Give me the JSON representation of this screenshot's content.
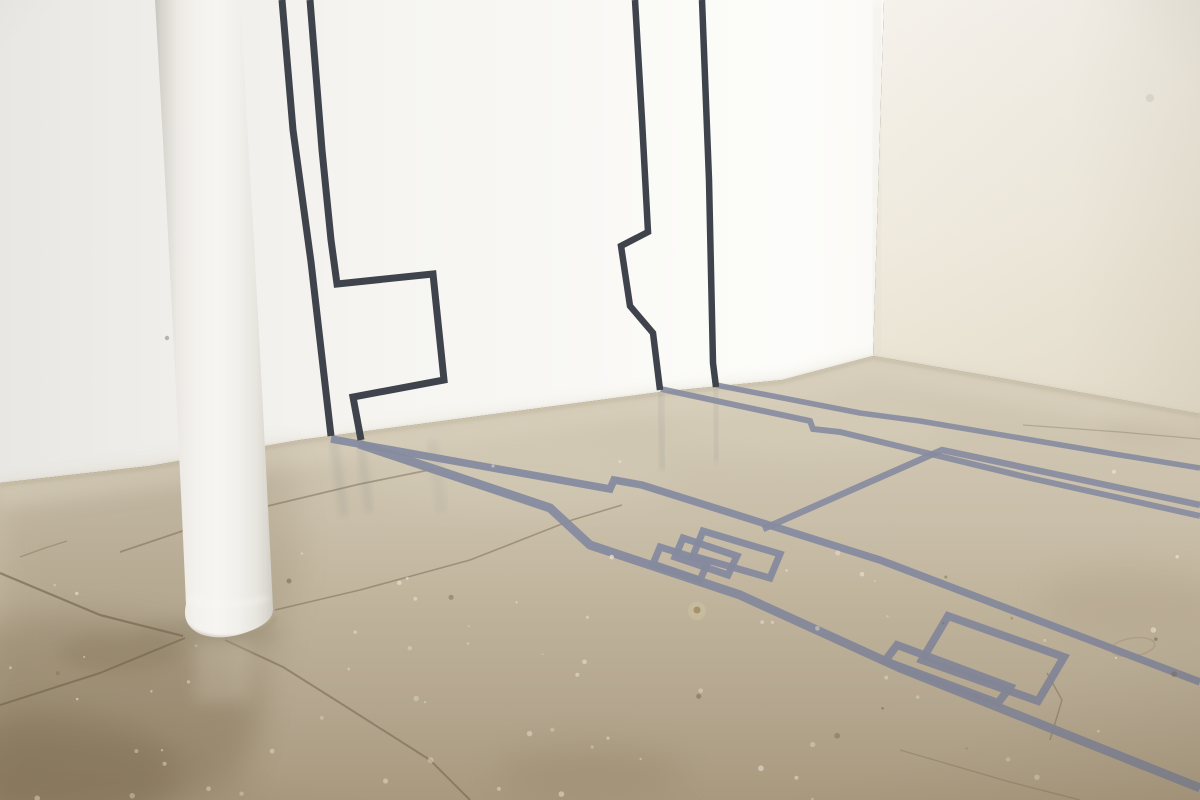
{
  "scene": {
    "label": "gallery-installation-photograph",
    "description": "White gallery room corner with a white cylindrical column at left; dark charcoal tape lines form an angular wall drawing that continues as a blue-grey tape drawing across a polished tan concrete floor with cracks and stains."
  },
  "colors": {
    "wall_tape": "#3f434c",
    "floor_tape": "#868ba0",
    "crack": "#6f5f49",
    "back_wall_bright": "#fcfcfa",
    "back_wall_dim": "#e9e7e3",
    "right_wall": "#f0ebdf",
    "floor_light": "#d4ccba",
    "floor_mid": "#c5b9a2",
    "floor_dark": "#b7a88e",
    "column_bright": "#f7f5f1",
    "column_shadow": "#c8c5be"
  },
  "artwork": {
    "wall_tape_paths": [
      {
        "name": "wall-tape-left-outer-line",
        "points": "282,0 293,130 311,262 331,436",
        "width": 7
      },
      {
        "name": "wall-tape-left-flag-line",
        "points": "310,0 322,150 331,240 337,284 433,274 444,380 353,397 361,440",
        "width": 7
      },
      {
        "name": "wall-tape-right-step-line",
        "points": "635,0 642,120 648,232 621,246 630,306 653,333 660,390",
        "width": 6.5
      },
      {
        "name": "wall-tape-right-straight-line",
        "points": "702,0 709,180 713,363 716,387",
        "width": 6.5
      }
    ],
    "floor_tape_paths": [
      {
        "name": "floor-tape-left-upper-diagonal",
        "points": "331,439 610,489 614,480 642,485 880,560 1200,682",
        "width": 7.5,
        "opacity": 0.95
      },
      {
        "name": "floor-tape-left-lower-diagonal",
        "points": "359,444 550,508 590,545 740,595 900,668 1200,788",
        "width": 9,
        "opacity": 0.95
      },
      {
        "name": "floor-tape-right-wall-parallel",
        "points": "716,385 860,413 920,421 1120,455 1200,468",
        "width": 5.5,
        "opacity": 0.9
      },
      {
        "name": "floor-tape-right-step-diagonal",
        "points": "661,389 810,421 813,429 840,432 1030,478 1200,516",
        "width": 6,
        "opacity": 0.9
      },
      {
        "name": "floor-tape-center-chevron",
        "points": "763,529 942,450 1200,505",
        "width": 6.5,
        "opacity": 0.9
      }
    ],
    "floor_comb_polygons": [
      {
        "name": "center-comb-bar-1",
        "points": "660,547 708,562 700,580 653,564",
        "width": 7
      },
      {
        "name": "center-comb-bar-2",
        "points": "683,538 737,556 728,575 675,557",
        "width": 7
      },
      {
        "name": "center-comb-bar-3",
        "points": "703,531 780,554 770,578 693,556",
        "width": 7
      },
      {
        "name": "front-comb-bar-large",
        "points": "948,616 1064,657 1038,701 922,660",
        "width": 8
      },
      {
        "name": "front-comb-bar-small",
        "points": "897,645 1010,687 998,703 885,661",
        "width": 8
      }
    ]
  },
  "floor": {
    "cracks": [
      {
        "name": "joint-left-to-column",
        "points": "0,573 100,615 183,636",
        "width": 2.2,
        "opacity": 0.6
      },
      {
        "name": "joint-behind-column",
        "points": "120,552 230,515 360,484 434,469",
        "width": 1.8,
        "opacity": 0.45
      },
      {
        "name": "joint-right-of-column",
        "points": "275,610 360,590 470,560 572,520 622,505",
        "width": 1.6,
        "opacity": 0.45
      },
      {
        "name": "joint-base-down-left",
        "points": "185,638 100,673 0,705",
        "width": 2,
        "opacity": 0.55
      },
      {
        "name": "joint-base-down-right",
        "points": "225,640 283,667 345,706 430,760 470,800",
        "width": 2,
        "opacity": 0.5
      },
      {
        "name": "crack-right-faint",
        "points": "1023,425 1120,432 1200,439",
        "width": 1.2,
        "opacity": 0.3
      },
      {
        "name": "crack-near-front-comb",
        "points": "1047,673 1062,700 1050,740",
        "width": 1.5,
        "opacity": 0.4
      },
      {
        "name": "scratch-left",
        "points": "20,557 45,548 67,541",
        "width": 1.3,
        "opacity": 0.35
      },
      {
        "name": "scratch-front-right",
        "points": "900,750 1010,782 1080,800",
        "width": 1.4,
        "opacity": 0.3
      }
    ]
  }
}
